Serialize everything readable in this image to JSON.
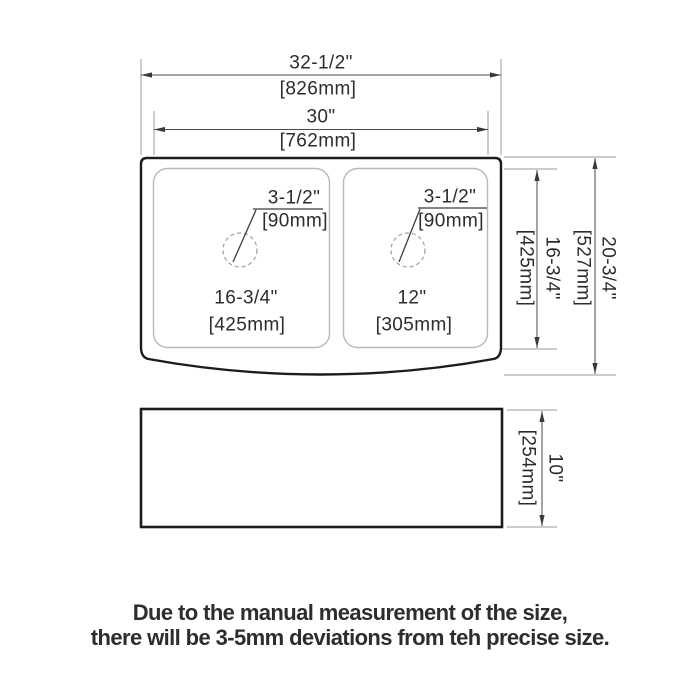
{
  "drawing": {
    "top_view": {
      "overall_width": {
        "inches": "32-1/2\"",
        "mm": "[826mm]"
      },
      "inner_width": {
        "inches": "30\"",
        "mm": "[762mm]"
      },
      "left_drain_diameter": {
        "inches": "3-1/2\"",
        "mm": "[90mm]"
      },
      "right_drain_diameter": {
        "inches": "3-1/2\"",
        "mm": "[90mm]"
      },
      "left_bowl_width": {
        "inches": "16-3/4\"",
        "mm": "[425mm]"
      },
      "right_bowl_width": {
        "inches": "12\"",
        "mm": "[305mm]"
      },
      "bowl_front_to_back": {
        "inches": "16-3/4\"",
        "mm": "[425mm]"
      },
      "overall_front_to_back": {
        "inches": "20-3/4\"",
        "mm": "[527mm]"
      }
    },
    "side_view": {
      "height": {
        "inches": "10\"",
        "mm": "[254mm]"
      }
    }
  },
  "footnote": {
    "line1": "Due to the manual measurement of the size,",
    "line2": "there will be 3-5mm deviations from teh precise size."
  },
  "colors": {
    "background": "#ffffff",
    "outline": "#1c1c1c",
    "bowl_line": "#b9b9b9",
    "drain_line": "#9f9f9f",
    "dimension_line": "#4a4a4a",
    "extension_line": "#9a9a9a",
    "arrow": "#3a3a3a",
    "text": "#2c2c2c"
  }
}
